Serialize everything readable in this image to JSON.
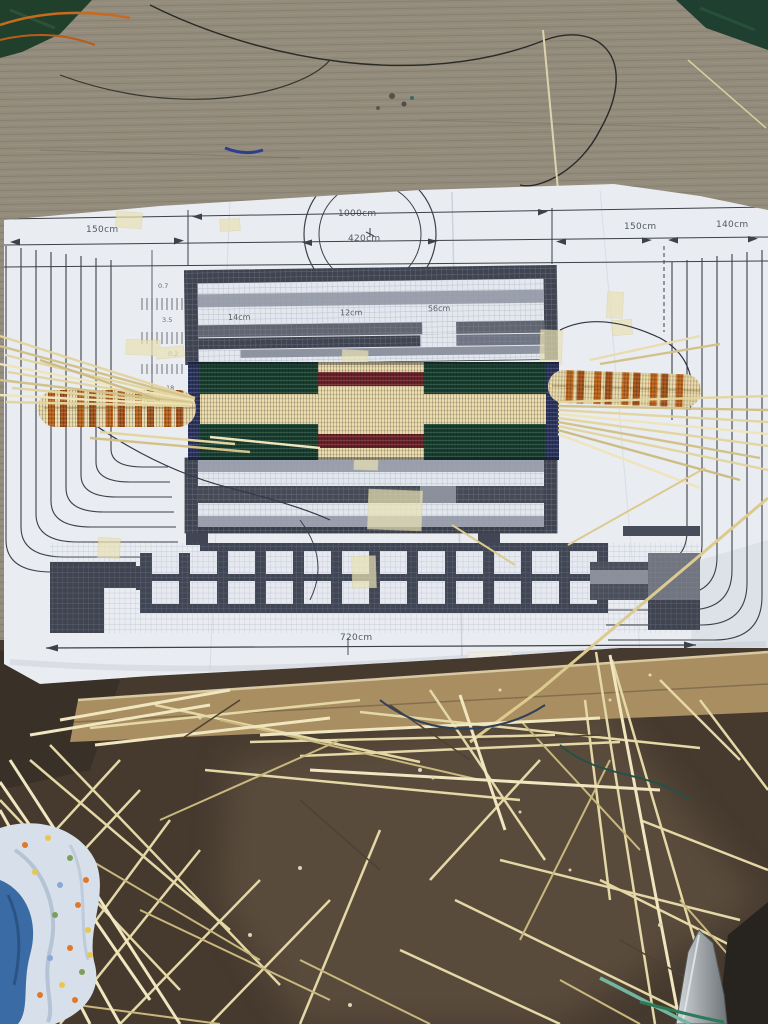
{
  "scene": {
    "type": "photograph",
    "subject": "Hand-woven striped band in progress laid over a printed weaving pattern sheet on a wooden table; loose straw fibres, fabric scraps, cardboard edge and a scissors blade on the ground below"
  },
  "pattern_sheet": {
    "top_ruler": {
      "left_span_label": "150cm",
      "outer_width_label": "1000cm",
      "inner_width_label": "420cm",
      "right_span_label": "150cm",
      "right_outer_span_label": "140cm"
    },
    "upper_chart": {
      "left_label": "14cm",
      "center_label": "12cm",
      "right_label": "56cm"
    },
    "left_margin_values": [
      "0.7",
      "3.5",
      "0.2",
      "18"
    ],
    "bottom_ruler": {
      "total_width_label": "720cm"
    }
  },
  "woven_band": {
    "colors": {
      "cream": "#e9d9a6",
      "orange_stripe": "#bf651b",
      "green": "#17412f",
      "maroon": "#6f2027",
      "navy_binding": "#2c3562"
    }
  },
  "palette": {
    "paper": "#e9ecf1",
    "print_ink": "#3d4148",
    "wood": "#8f8878",
    "soil": "#463a2f",
    "cardboard": "#a98e62",
    "straw": "#e4d8a6"
  }
}
